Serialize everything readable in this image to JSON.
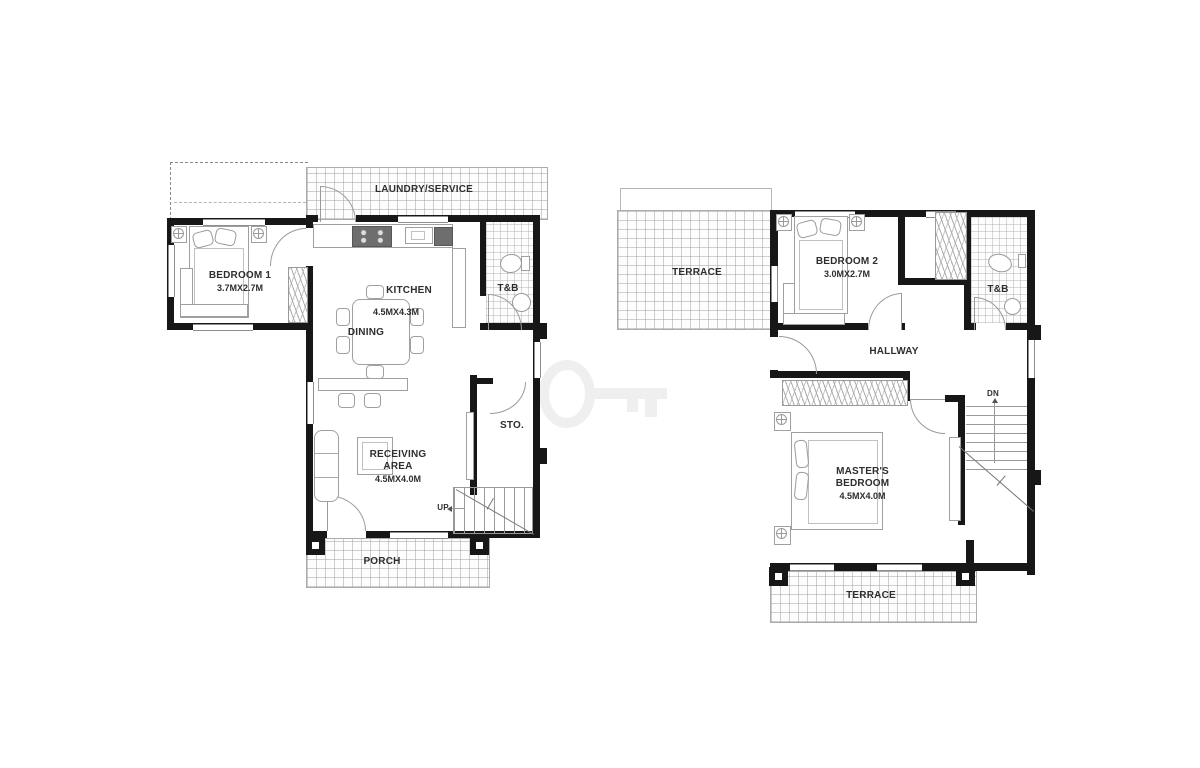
{
  "ground_floor": {
    "laundry_label": "LAUNDRY/SERVICE",
    "bedroom1_label": "BEDROOM 1",
    "bedroom1_dims": "3.7MX2.7M",
    "kitchen_label": "KITCHEN",
    "kitchen_dims": "4.5MX4.3M",
    "dining_label": "DINING",
    "toilet_label": "T&B",
    "storage_label": "STO.",
    "receiving_label_line1": "RECEIVING",
    "receiving_label_line2": "AREA",
    "receiving_dims": "4.5MX4.0M",
    "stairs_label": "UP",
    "porch_label": "PORCH"
  },
  "second_floor": {
    "terrace_upper_label": "TERRACE",
    "bedroom2_label": "BEDROOM 2",
    "bedroom2_dims": "3.0MX2.7M",
    "toilet_label": "T&B",
    "hallway_label": "HALLWAY",
    "master_label_line1": "MASTER'S",
    "master_label_line2": "BEDROOM",
    "master_dims": "4.5MX4.0M",
    "stairs_label": "DN",
    "terrace_lower_label": "TERRACE"
  },
  "colors": {
    "wall": "#171717",
    "furniture_line": "#a0a0a0",
    "label_text": "#2e2e2e",
    "watermark": "#efefef",
    "background": "#ffffff"
  }
}
